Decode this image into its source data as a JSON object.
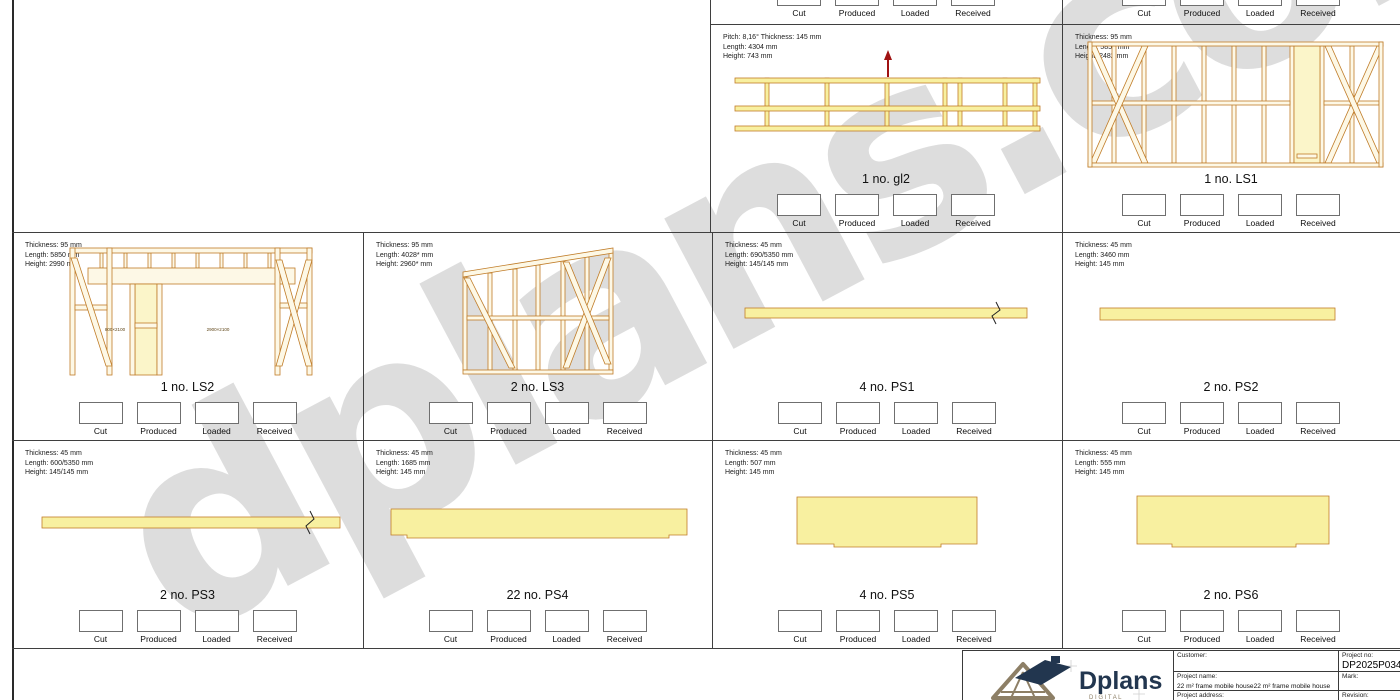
{
  "watermark": "dplans.com",
  "checkbox_labels": [
    "Cut",
    "Produced",
    "Loaded",
    "Received"
  ],
  "panels": {
    "gl2": {
      "specs": [
        "Pitch: 8,16° Thickness: 145 mm",
        "Length: 4304 mm",
        "Height: 743 mm"
      ],
      "name": "1 no. gl2"
    },
    "ls1": {
      "specs": [
        "Thickness: 95 mm",
        "Length: 5850 mm",
        "Height: 2482 mm"
      ],
      "name": "1 no. LS1"
    },
    "ls2": {
      "specs": [
        "Thickness: 95 mm",
        "Length: 5850 mm",
        "Height: 2990 mm"
      ],
      "name": "1 no. LS2",
      "opening_labels": [
        "800×2100",
        "2900×2100"
      ]
    },
    "ls3": {
      "specs": [
        "Thickness: 95 mm",
        "Length: 4028* mm",
        "Height: 2960* mm"
      ],
      "name": "2 no. LS3"
    },
    "ps1": {
      "specs": [
        "Thickness: 45 mm",
        "Length: 690/5350 mm",
        "Height: 145/145 mm"
      ],
      "name": "4 no. PS1"
    },
    "ps2": {
      "specs": [
        "Thickness: 45 mm",
        "Length: 3460 mm",
        "Height: 145 mm"
      ],
      "name": "2 no. PS2"
    },
    "ps3": {
      "specs": [
        "Thickness: 45 mm",
        "Length: 600/5350 mm",
        "Height: 145/145 mm"
      ],
      "name": "2 no. PS3"
    },
    "ps4": {
      "specs": [
        "Thickness: 45 mm",
        "Length: 1685 mm",
        "Height: 145 mm"
      ],
      "name": "22 no. PS4"
    },
    "ps5": {
      "specs": [
        "Thickness: 45 mm",
        "Length: 507 mm",
        "Height: 145 mm"
      ],
      "name": "4 no. PS5"
    },
    "ps6": {
      "specs": [
        "Thickness: 45 mm",
        "Length: 555 mm",
        "Height: 145 mm"
      ],
      "name": "2 no. PS6"
    }
  },
  "title_block": {
    "logo_text": "Dplans",
    "logo_subtext": "D I G I T A L",
    "customer_label": "Customer:",
    "customer_value": "",
    "project_no_label": "Project no:",
    "project_no_value": "DP2025P034",
    "project_name_label": "Project name:",
    "project_name_value": "22 m² frame mobile house22 m² frame mobile house",
    "mark_label": "Mark:",
    "mark_value": "",
    "project_address_label": "Project address:",
    "project_address_value": "",
    "revision_label": "Revision:",
    "revision_value": ""
  },
  "colors": {
    "wood_outline": "#c07c28",
    "frame_fill": "#fdf8e6",
    "plank_fill": "#f8f0a0",
    "arrow_red": "#a01313",
    "watermark_gray": "#bdbdbd",
    "logo_navy": "#22364f",
    "logo_taupe": "#8d7f66"
  }
}
